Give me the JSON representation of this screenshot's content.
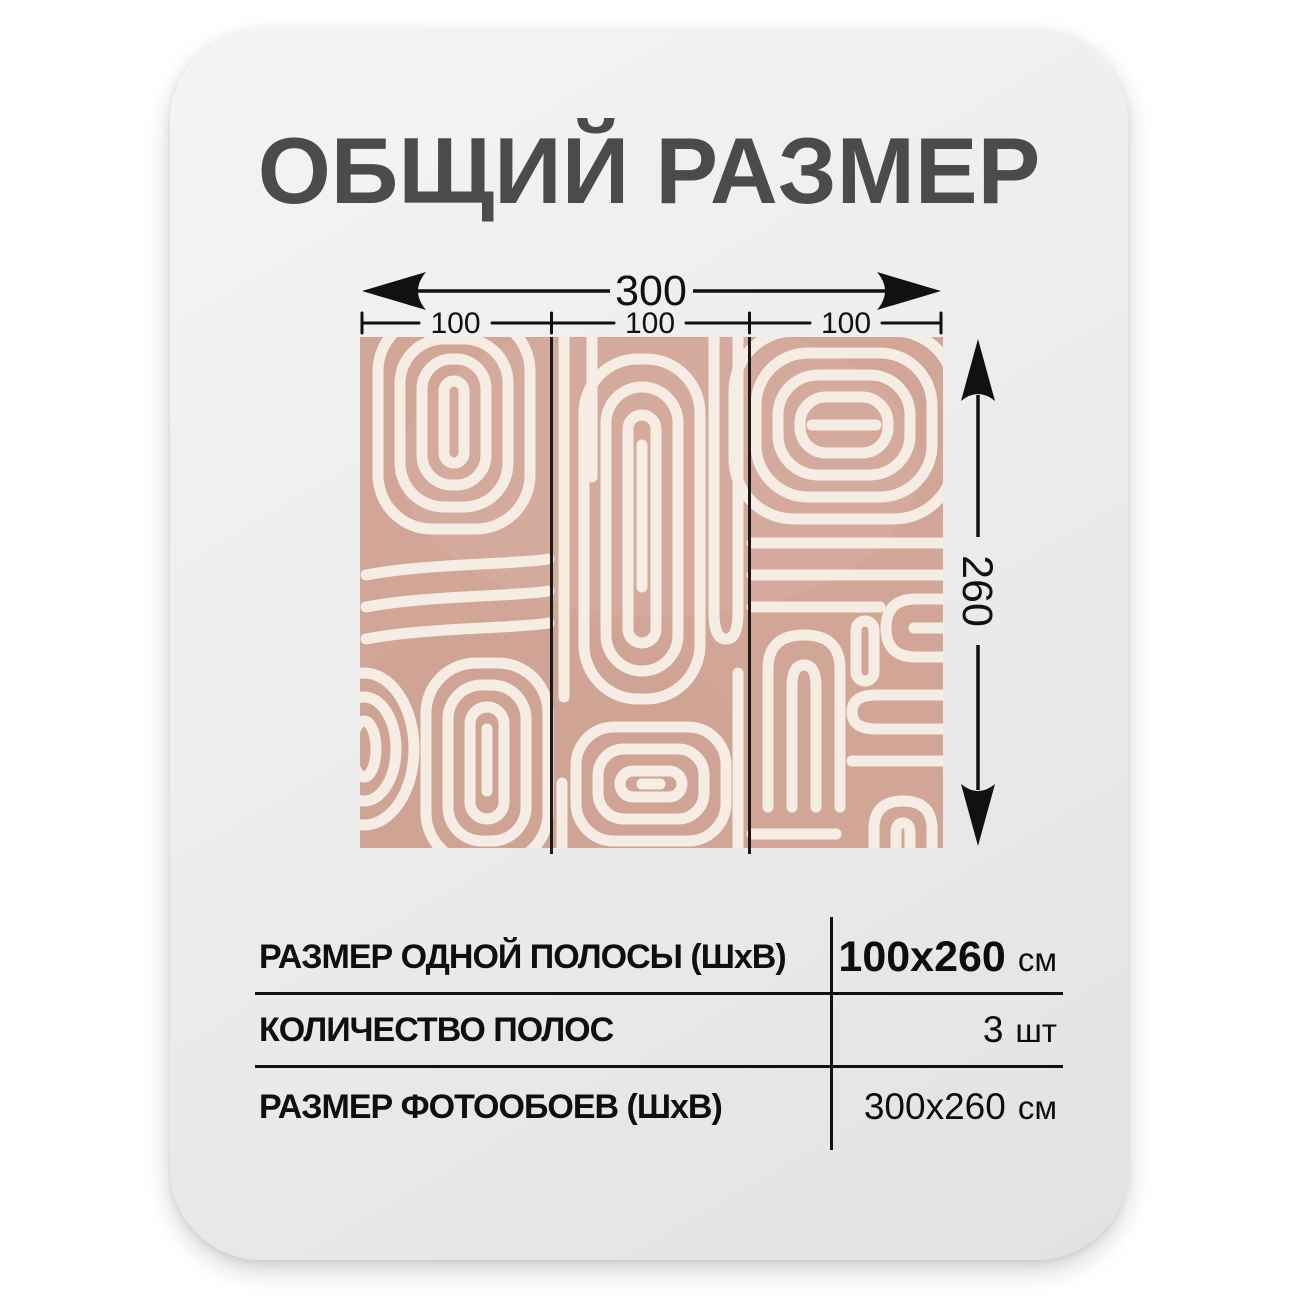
{
  "title": "ОБЩИЙ РАЗМЕР",
  "title_color": "#4b4b4b",
  "page_background": "#ffffff",
  "card": {
    "background": "#ececec"
  },
  "diagram": {
    "total_width_label": "300",
    "segment_labels": [
      "100",
      "100",
      "100"
    ],
    "height_label": "260",
    "dimension_color": "#111111",
    "pattern": {
      "name": "abstract-maze-line-wallpaper",
      "panel_count": 3,
      "background_color": "#d1a697",
      "line_color": "#f5ede3",
      "divider_color": "#1b1b1b"
    }
  },
  "spec_table": {
    "line_color": "#111111",
    "rows": [
      {
        "label": "РАЗМЕР ОДНОЙ ПОЛОСЫ (ШхВ)",
        "value": "100x260",
        "unit": "см"
      },
      {
        "label": "КОЛИЧЕСТВО ПОЛОС",
        "value": "3",
        "unit": "шт"
      },
      {
        "label": "РАЗМЕР ФОТООБОЕВ (ШхВ)",
        "value": "300x260",
        "unit": "см"
      }
    ]
  }
}
